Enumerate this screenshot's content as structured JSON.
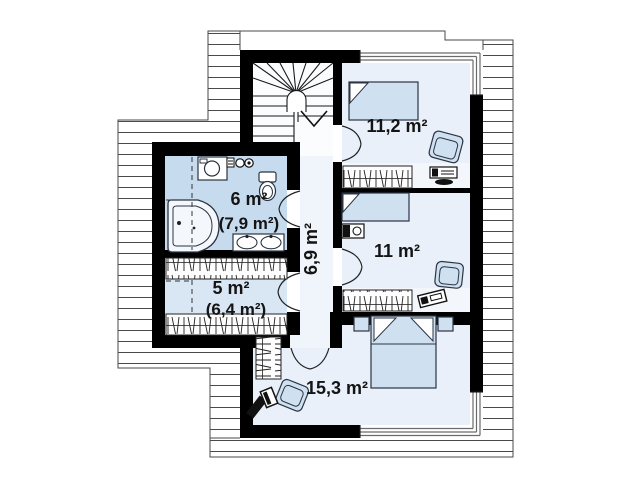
{
  "plan": {
    "rooms": {
      "bedroom_top": {
        "area": "11,2 m²"
      },
      "bedroom_mid": {
        "area": "11 m²"
      },
      "bedroom_big": {
        "area": "15,3 m²"
      },
      "bathroom": {
        "area": "6 m²",
        "area_total": "(7,9 m²)"
      },
      "wardrobe": {
        "area": "5 m²",
        "area_total": "(6,4 m²)"
      },
      "hall": {
        "area": "6,9 m²"
      }
    },
    "colors": {
      "wall": "#000000",
      "bathroom_floor": "#c7dbee",
      "wardrobe_floor": "#d9e6f3",
      "room_floor": "#e9f0f9",
      "band_floor": "#f3f7fc",
      "hall_floor": "#f0f5fb",
      "furniture_fill": "#cfe0f0",
      "hatch_line": "#4a4a4a"
    }
  }
}
